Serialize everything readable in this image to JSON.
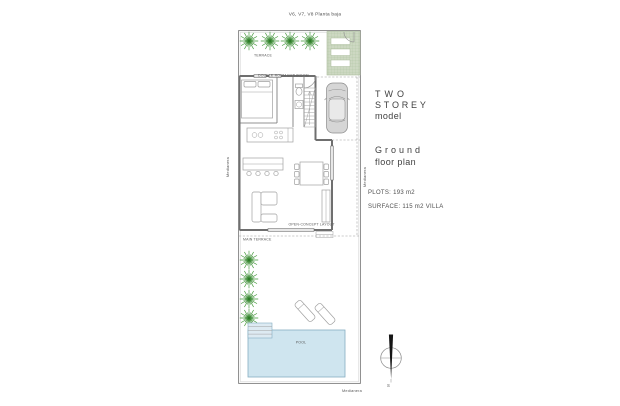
{
  "page_title": "V6, V7, V8 Planta baja",
  "plan": {
    "terrace_label": "TERRACE",
    "rooms_label": "DOUBLE ROOM BATHROOM",
    "open_concept_label": "OPEN-CONCEPT LAYOUT",
    "main_terrace_label": "MAIN TERRACE",
    "pool_label": "POOL",
    "boundary_labels": {
      "left": "Medianera",
      "right": "Medianera",
      "bottom": "Medianera"
    }
  },
  "info_panel": {
    "model_name_line1": "TWO",
    "model_name_line2": "STOREY",
    "model_suffix": "model",
    "floor_line1": "Ground",
    "floor_line2": "floor plan",
    "plots": "PLOTS: 193 m2",
    "surface": "SURFACE: 115 m2 VILLA"
  },
  "compass": {
    "south_label": "S"
  },
  "colors": {
    "palm-green": "#3f9636",
    "palm-green-dark": "#2e7d28",
    "garden-fill": "#cdd8c2",
    "garden-line": "#a9bb9a",
    "pool-fill": "#cfe5ef",
    "pool-line": "#85aec2",
    "wall-grey": "#6f6f6f",
    "line-grey": "#a0a0a0",
    "text-dark": "#3f3f3f",
    "text-grey": "#4f4f4f"
  }
}
